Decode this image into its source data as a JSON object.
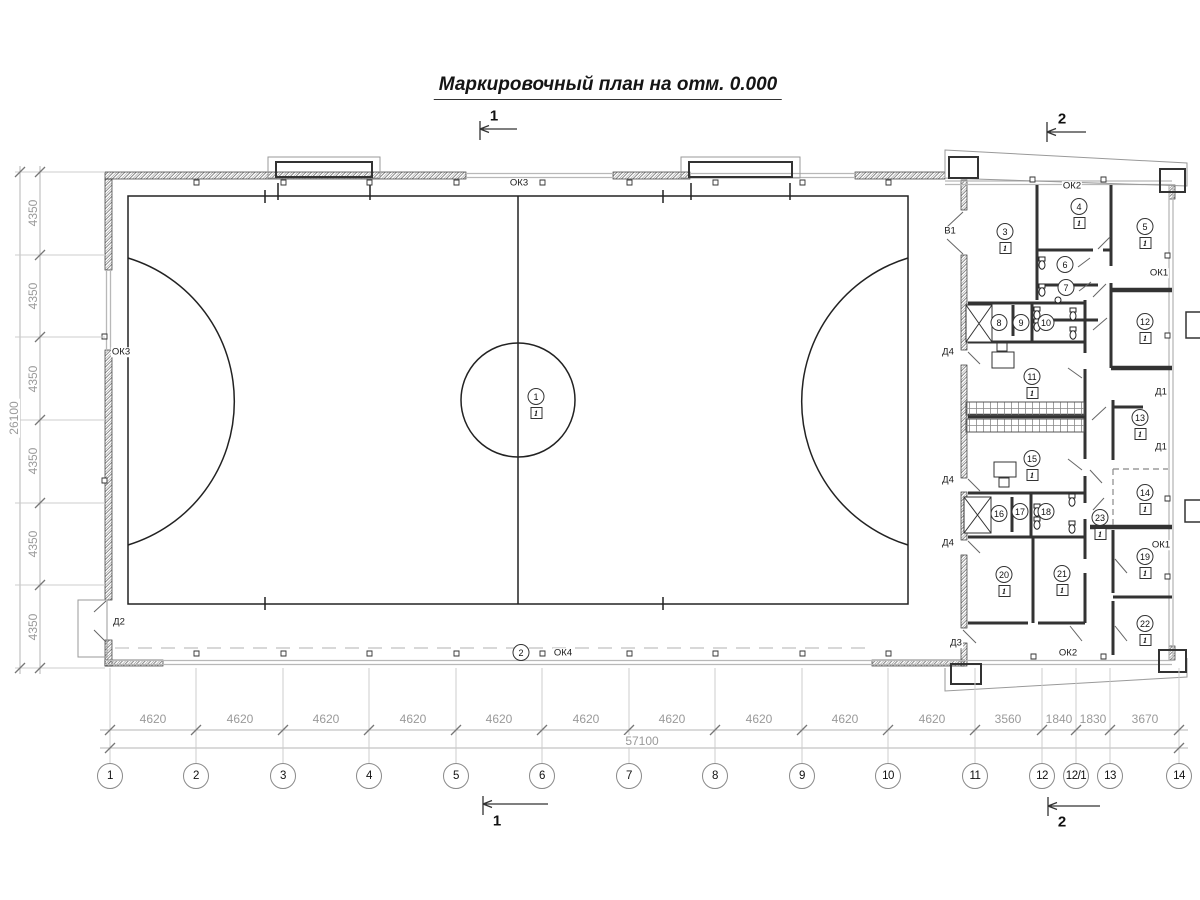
{
  "title": "Маркировочный план на отм. 0.000",
  "finish_tag": "1",
  "section_markers": [
    {
      "label": "1",
      "x": 494,
      "y": 116
    },
    {
      "label": "2",
      "x": 1062,
      "y": 119
    },
    {
      "label": "1",
      "x": 497,
      "y": 821
    },
    {
      "label": "2",
      "x": 1062,
      "y": 822
    }
  ],
  "grid_bubbles": [
    {
      "label": "1",
      "x": 110
    },
    {
      "label": "2",
      "x": 196
    },
    {
      "label": "3",
      "x": 283
    },
    {
      "label": "4",
      "x": 369
    },
    {
      "label": "5",
      "x": 456
    },
    {
      "label": "6",
      "x": 542
    },
    {
      "label": "7",
      "x": 629
    },
    {
      "label": "8",
      "x": 715
    },
    {
      "label": "9",
      "x": 802
    },
    {
      "label": "10",
      "x": 888
    },
    {
      "label": "11",
      "x": 975
    },
    {
      "label": "12",
      "x": 1042
    },
    {
      "label": "12/1",
      "x": 1076
    },
    {
      "label": "13",
      "x": 1110
    },
    {
      "label": "14",
      "x": 1179
    }
  ],
  "dims_bottom": [
    {
      "text": "4620",
      "x": 153
    },
    {
      "text": "4620",
      "x": 240
    },
    {
      "text": "4620",
      "x": 326
    },
    {
      "text": "4620",
      "x": 413
    },
    {
      "text": "4620",
      "x": 499
    },
    {
      "text": "4620",
      "x": 586
    },
    {
      "text": "4620",
      "x": 672
    },
    {
      "text": "4620",
      "x": 759
    },
    {
      "text": "4620",
      "x": 845
    },
    {
      "text": "4620",
      "x": 932
    },
    {
      "text": "3560",
      "x": 1008
    },
    {
      "text": "1840",
      "x": 1059
    },
    {
      "text": "1830",
      "x": 1093
    },
    {
      "text": "3670",
      "x": 1145
    }
  ],
  "dims_left": [
    {
      "text": "4350",
      "y": 213
    },
    {
      "text": "4350",
      "y": 296
    },
    {
      "text": "4350",
      "y": 379
    },
    {
      "text": "4350",
      "y": 461
    },
    {
      "text": "4350",
      "y": 544
    },
    {
      "text": "4350",
      "y": 627
    }
  ],
  "dim_totals": [
    {
      "text": "57100",
      "x": 642,
      "y": 741
    },
    {
      "text": "26100",
      "x": 14,
      "y": 418,
      "rot": true
    }
  ],
  "wall_labels": [
    {
      "text": "ОК3",
      "x": 519,
      "y": 183
    },
    {
      "text": "ОК3",
      "x": 121,
      "y": 352
    },
    {
      "text": "ОК4",
      "x": 563,
      "y": 653
    },
    {
      "text": "ОК2",
      "x": 1072,
      "y": 186
    },
    {
      "text": "ОК2",
      "x": 1068,
      "y": 653
    },
    {
      "text": "ОК1",
      "x": 1159,
      "y": 273
    },
    {
      "text": "ОК1",
      "x": 1161,
      "y": 545
    },
    {
      "text": "В1",
      "x": 950,
      "y": 231
    },
    {
      "text": "Д2",
      "x": 119,
      "y": 622
    },
    {
      "text": "Д3",
      "x": 956,
      "y": 643
    },
    {
      "text": "Д4",
      "x": 948,
      "y": 352
    },
    {
      "text": "Д4",
      "x": 948,
      "y": 480
    },
    {
      "text": "Д4",
      "x": 948,
      "y": 543
    },
    {
      "text": "Д1",
      "x": 1161,
      "y": 392
    },
    {
      "text": "Д1",
      "x": 1161,
      "y": 447
    }
  ],
  "room_tags": [
    {
      "num": "1",
      "x": 536,
      "y": 397,
      "boxed": true
    },
    {
      "num": "2",
      "x": 521,
      "y": 653,
      "boxed": false
    },
    {
      "num": "3",
      "x": 1005,
      "y": 232,
      "boxed": true
    },
    {
      "num": "4",
      "x": 1079,
      "y": 207,
      "boxed": true
    },
    {
      "num": "5",
      "x": 1145,
      "y": 227,
      "boxed": true
    },
    {
      "num": "6",
      "x": 1065,
      "y": 265,
      "boxed": false
    },
    {
      "num": "7",
      "x": 1066,
      "y": 288,
      "boxed": false
    },
    {
      "num": "8",
      "x": 999,
      "y": 323,
      "boxed": false
    },
    {
      "num": "9",
      "x": 1021,
      "y": 323,
      "boxed": false
    },
    {
      "num": "10",
      "x": 1046,
      "y": 323,
      "boxed": false
    },
    {
      "num": "11",
      "x": 1032,
      "y": 377,
      "boxed": true
    },
    {
      "num": "12",
      "x": 1145,
      "y": 322,
      "boxed": true
    },
    {
      "num": "13",
      "x": 1140,
      "y": 418,
      "boxed": true
    },
    {
      "num": "14",
      "x": 1145,
      "y": 493,
      "boxed": true
    },
    {
      "num": "15",
      "x": 1032,
      "y": 459,
      "boxed": true
    },
    {
      "num": "16",
      "x": 999,
      "y": 514,
      "boxed": false
    },
    {
      "num": "17",
      "x": 1020,
      "y": 512,
      "boxed": false
    },
    {
      "num": "18",
      "x": 1046,
      "y": 512,
      "boxed": false
    },
    {
      "num": "19",
      "x": 1145,
      "y": 557,
      "boxed": true
    },
    {
      "num": "20",
      "x": 1004,
      "y": 575,
      "boxed": true
    },
    {
      "num": "21",
      "x": 1062,
      "y": 574,
      "boxed": true
    },
    {
      "num": "22",
      "x": 1145,
      "y": 624,
      "boxed": true
    },
    {
      "num": "23",
      "x": 1100,
      "y": 518,
      "boxed": true
    }
  ]
}
